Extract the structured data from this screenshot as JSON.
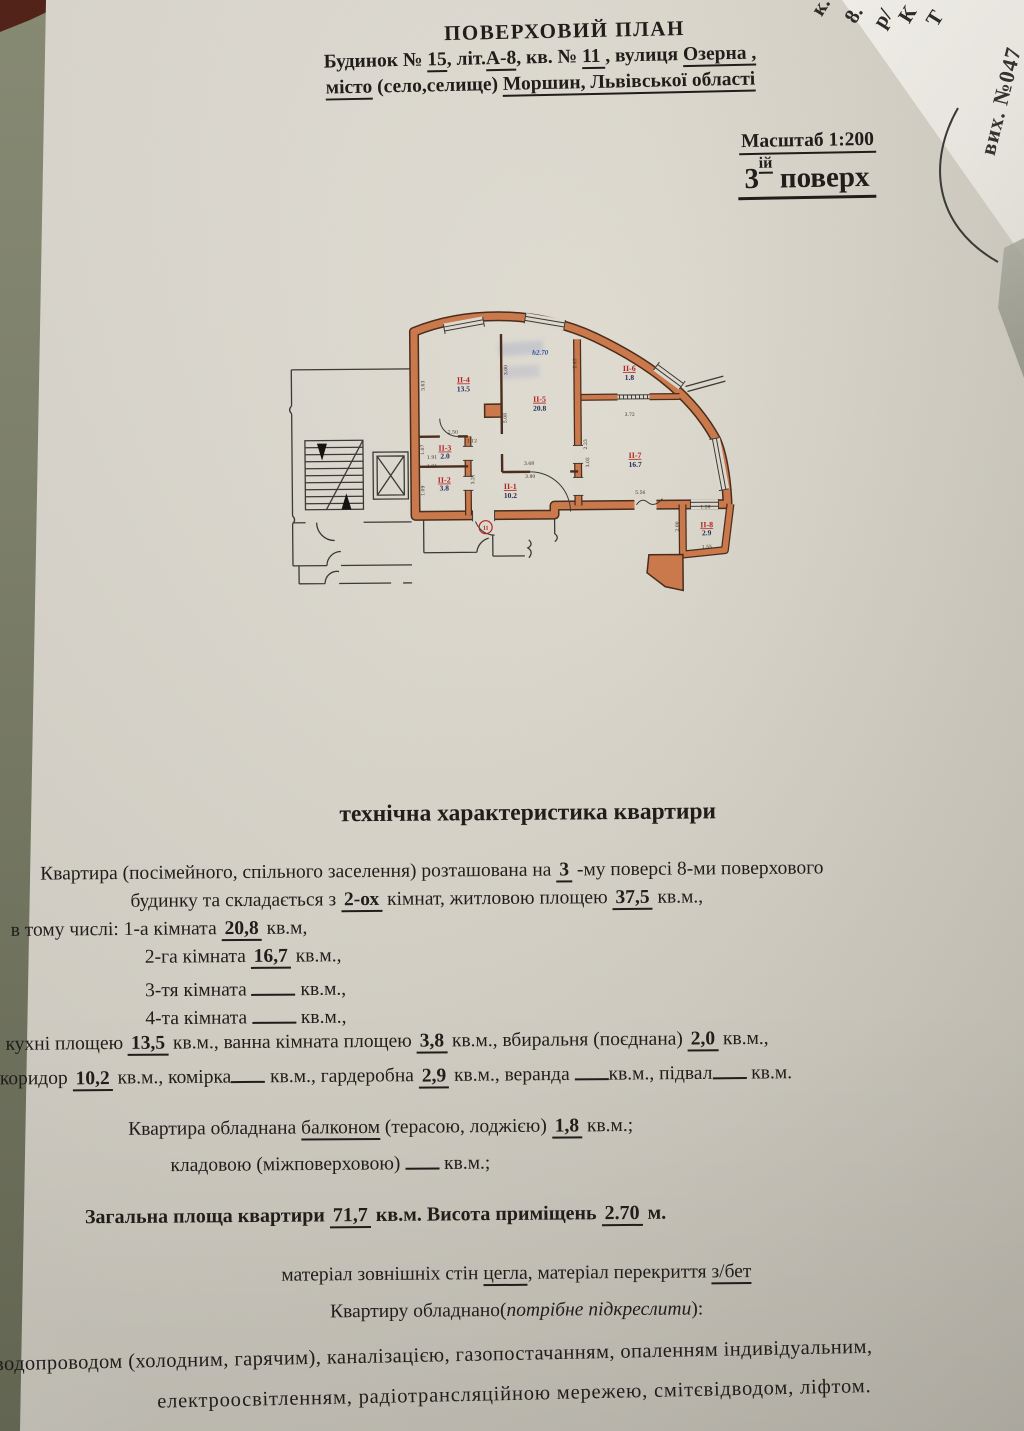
{
  "header": {
    "title": "ПОВЕРХОВИЙ ПЛАН",
    "line2": [
      {
        "t": "Будинок № "
      },
      {
        "t": "15",
        "s": "ul"
      },
      {
        "t": ", літ."
      },
      {
        "t": "А-8",
        "s": "ul"
      },
      {
        "t": ", кв. № "
      },
      {
        "t": "  11  ",
        "s": "ul"
      },
      {
        "t": ", вулиця "
      },
      {
        "t": "Озерна ,",
        "s": "ul"
      }
    ],
    "line3": [
      {
        "t": "місто",
        "s": "ul"
      },
      {
        "t": " (село,селище) "
      },
      {
        "t": "Моршин, Львівської області",
        "s": "ul"
      }
    ],
    "scale": "Масштаб 1:200",
    "floor_num": "3",
    "floor_sup": "ій",
    "floor_word": " поверх"
  },
  "side_paper": {
    "stamp": "вих. №047",
    "fragments": [
      "к.",
      "8.",
      "р/",
      "К",
      "Т"
    ]
  },
  "plan": {
    "rooms": [
      {
        "id": "II-4",
        "area": "13.5"
      },
      {
        "id": "II-5",
        "area": "20.8"
      },
      {
        "id": "II-6",
        "area": "1.8"
      },
      {
        "id": "II-7",
        "area": "16.7"
      },
      {
        "id": "II-3",
        "area": "2.0"
      },
      {
        "id": "II-2",
        "area": "3.8"
      },
      {
        "id": "II-1",
        "area": "10.2"
      },
      {
        "id": "II-8",
        "area": "2.9"
      }
    ],
    "height_label": "h2.70",
    "apartment_number": "11",
    "dims": [
      "3.63",
      "3.00",
      "2.45",
      "2.50",
      "1.12",
      "1.07",
      "1.91",
      "1.91",
      "1.09",
      "3.21",
      "5.08",
      "3.68",
      "3.80",
      "2.23",
      "3.02",
      "3.72",
      "5.56",
      "1.28",
      "1.55",
      "2.00"
    ]
  },
  "tech": {
    "heading": "технічна характеристика квартири",
    "lines": [
      [
        {
          "t": "Квартира (посімейного, спільного заселення) розташована на      "
        },
        {
          "t": "3",
          "s": "v"
        },
        {
          "t": "   -му  поверсі 8-ми поверхового"
        }
      ],
      [
        {
          "t": "будинку та складається з  "
        },
        {
          "t": "2-ох",
          "s": "v"
        },
        {
          "t": "    кімнат,       житловою площею   "
        },
        {
          "t": "37,5",
          "s": "v"
        },
        {
          "t": "  кв.м.,"
        }
      ],
      [
        {
          "t": "в тому числі: 1-а кімната   "
        },
        {
          "t": "20,8",
          "s": "v"
        },
        {
          "t": "  кв.м,"
        }
      ],
      [
        {
          "t": "2-га кімната  "
        },
        {
          "t": "16,7",
          "s": "v"
        },
        {
          "t": "  кв.м.,"
        }
      ],
      [
        {
          "t": "3-тя кімната  "
        },
        {
          "t": "",
          "s": "g"
        },
        {
          "t": "  кв.м.,"
        }
      ],
      [
        {
          "t": "4-та кімната  "
        },
        {
          "t": "",
          "s": "g"
        },
        {
          "t": "  кв.м.,"
        }
      ],
      [
        {
          "t": "кухні площею   "
        },
        {
          "t": "13,5",
          "s": "v"
        },
        {
          "t": "  кв.м.,   ванна кімната площею      "
        },
        {
          "t": "3,8",
          "s": "v"
        },
        {
          "t": "      кв.м.,  вбиральня (поєднана) "
        },
        {
          "t": "2,0",
          "s": "v"
        },
        {
          "t": " кв.м.,"
        }
      ],
      [
        {
          "t": "коридор  "
        },
        {
          "t": "10,2",
          "s": "v"
        },
        {
          "t": "   кв.м., комірка"
        },
        {
          "t": "",
          "s": "g2"
        },
        {
          "t": " кв.м., гардеробна "
        },
        {
          "t": "2,9",
          "s": "v"
        },
        {
          "t": "  кв.м., веранда "
        },
        {
          "t": "",
          "s": "g2"
        },
        {
          "t": "кв.м., підвал"
        },
        {
          "t": "",
          "s": "g2"
        },
        {
          "t": " кв.м."
        }
      ],
      [
        {
          "t": "Квартира обладнана "
        },
        {
          "t": "балконом",
          "s": "ul"
        },
        {
          "t": " (терасою, лоджією)      "
        },
        {
          "t": "1,8",
          "s": "v"
        },
        {
          "t": "       кв.м.;"
        }
      ],
      [
        {
          "t": "кладовою (міжповерховою) "
        },
        {
          "t": "",
          "s": "g2"
        },
        {
          "t": "  кв.м.;"
        }
      ],
      [
        {
          "t": "Загальна площа квартири   ",
          "s": "b"
        },
        {
          "t": "71,7",
          "s": "v"
        },
        {
          "t": "  кв.м.",
          "s": "b"
        },
        {
          "t": "           Висота приміщень    ",
          "s": "b"
        },
        {
          "t": "2.70",
          "s": "v"
        },
        {
          "t": "   м.",
          "s": "b"
        }
      ],
      [
        {
          "t": "матеріал зовнішніх стін "
        },
        {
          "t": "цегла",
          "s": "ul"
        },
        {
          "t": ", матеріал перекриття "
        },
        {
          "t": "з/бет",
          "s": "ul"
        }
      ],
      [
        {
          "t": "Квартиру обладнано("
        },
        {
          "t": "потрібне підкреслити",
          "s": "i"
        },
        {
          "t": "):"
        }
      ],
      [
        {
          "t": "водопроводом (холодним, гарячим), каналізацією, газопостачанням, опаленням  індивідуальним,"
        }
      ],
      [
        {
          "t": "електроосвітленням, радіотрансляційною мережею, смітєвідводом, ліфтом."
        }
      ]
    ]
  }
}
